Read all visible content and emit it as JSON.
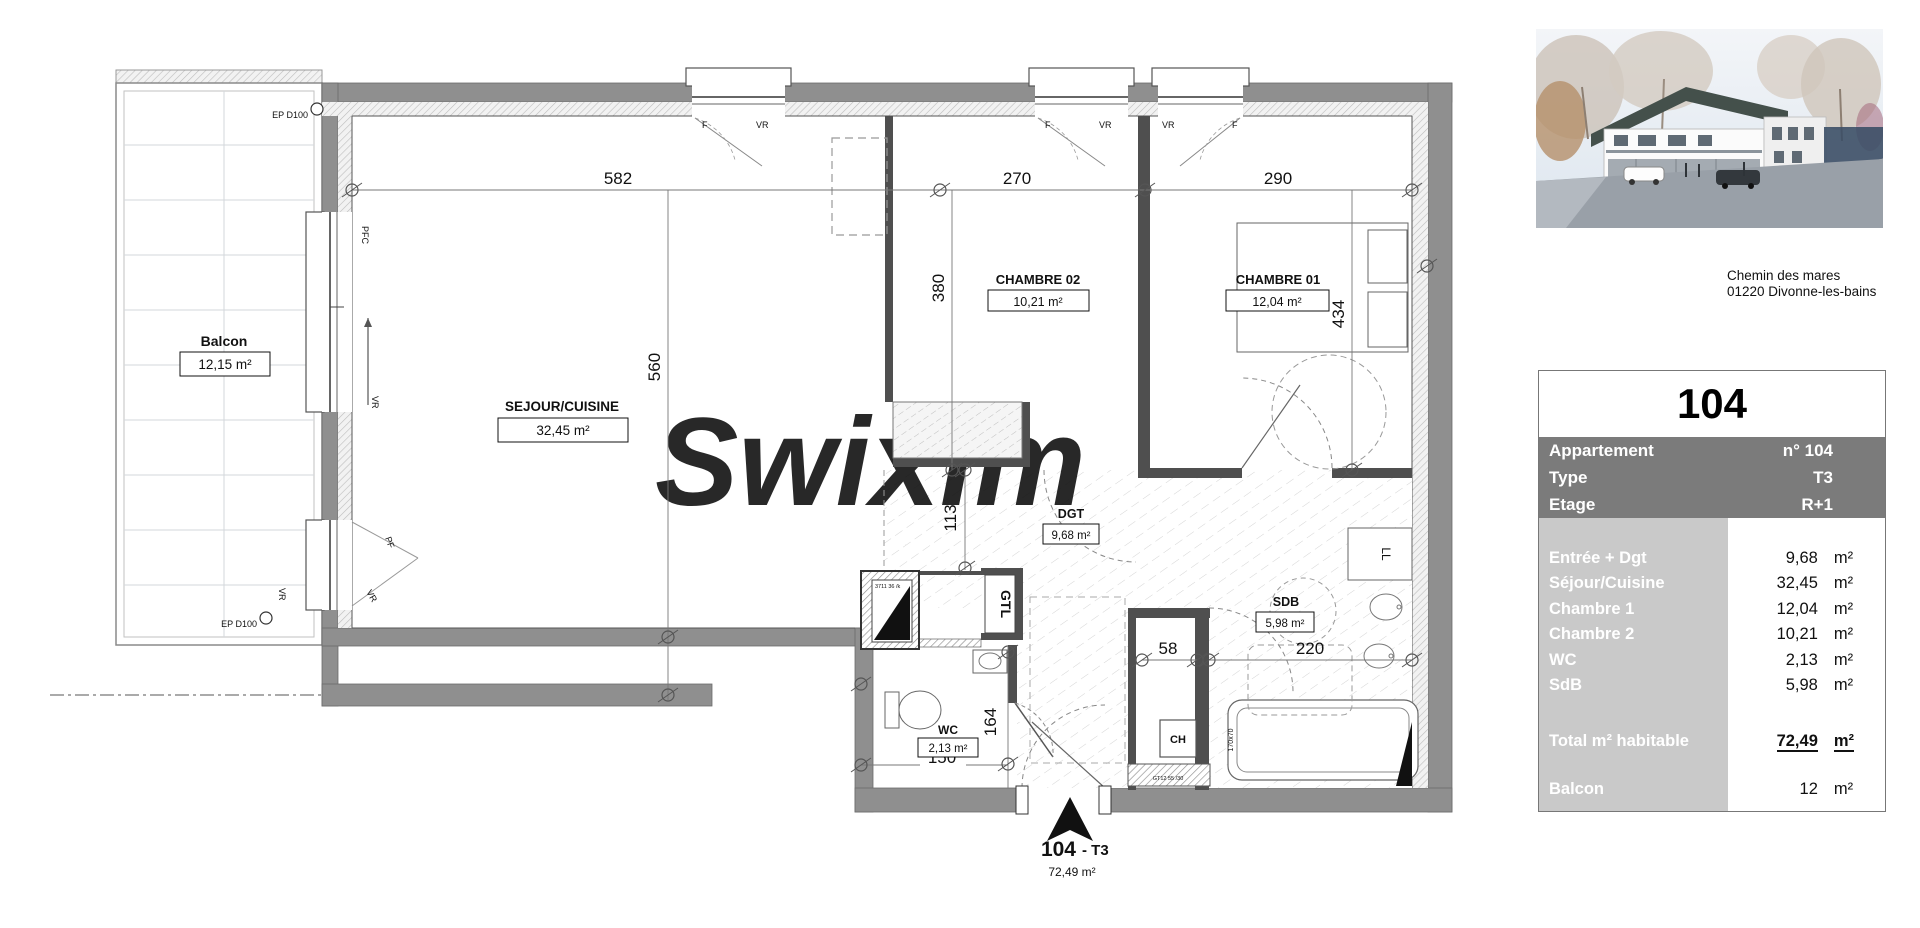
{
  "address": {
    "line1": "Chemin des mares",
    "line2": "01220 Divonne-les-bains"
  },
  "unit_card": {
    "title": "104",
    "info_rows": [
      {
        "label": "Appartement",
        "value": "n° 104"
      },
      {
        "label": "Type",
        "value": "T3"
      },
      {
        "label": "Etage",
        "value": "R+1"
      }
    ],
    "area_rows": [
      {
        "label": "Entrée + Dgt",
        "value": "9,68",
        "unit": "m²"
      },
      {
        "label": "Séjour/Cuisine",
        "value": "32,45",
        "unit": "m²"
      },
      {
        "label": "Chambre 1",
        "value": "12,04",
        "unit": "m²"
      },
      {
        "label": "Chambre 2",
        "value": "10,21",
        "unit": "m²"
      },
      {
        "label": "WC",
        "value": "2,13",
        "unit": "m²"
      },
      {
        "label": "SdB",
        "value": "5,98",
        "unit": "m²"
      }
    ],
    "total_row": {
      "label": "Total m² habitable",
      "value": "72,49",
      "unit": "m²"
    },
    "balcony_row": {
      "label": "Balcon",
      "value": "12",
      "unit": "m²"
    },
    "colors": {
      "header_band": "#7b7b7b",
      "label_column": "#c9c9c9"
    }
  },
  "floorplan": {
    "watermark": "Swixim",
    "rooms": {
      "balcon": {
        "name": "Balcon",
        "area": "12,15 m²"
      },
      "sejour": {
        "name": "SEJOUR/CUISINE",
        "area": "32,45 m²"
      },
      "chambre2": {
        "name": "CHAMBRE 02",
        "area": "10,21 m²"
      },
      "chambre1": {
        "name": "CHAMBRE 01",
        "area": "12,04 m²"
      },
      "dgt": {
        "name": "DGT",
        "area": "9,68 m²"
      },
      "sdb": {
        "name": "SDB",
        "area": "5,98 m²"
      },
      "wc": {
        "name": "WC",
        "area": "2,13 m²"
      }
    },
    "dims": {
      "top_sejour": "582",
      "top_ch2": "270",
      "top_ch1": "290",
      "sejour_h": "560",
      "ch2_h": "380",
      "ch1_h": "434",
      "dgt_w": "113",
      "wc_h": "164",
      "wc_w": "150",
      "ch_col_w": "58",
      "sdb_w": "220"
    },
    "labels": {
      "ep": "EP D100",
      "f": "F",
      "vr": "VR",
      "pfc": "PFC",
      "pf": "PF",
      "gtl": "GTL",
      "ch": "CH",
      "ll": "LL",
      "shaft": "3711 36 /k",
      "tub": "170x70",
      "gt": "GT12 55 /30"
    },
    "entrance": {
      "number": "104",
      "type": "- T3",
      "area": "72,49 m²"
    }
  }
}
